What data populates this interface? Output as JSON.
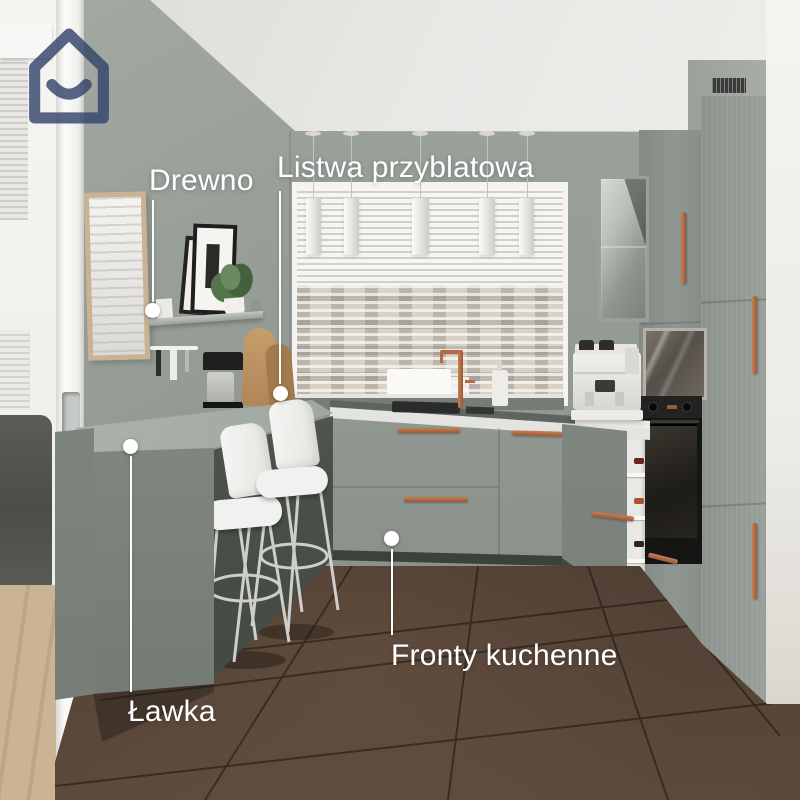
{
  "brand": {
    "logo_icon": "house-smile-logo",
    "logo_color": "#35456b"
  },
  "annotations": {
    "drewno": {
      "label": "Drewno"
    },
    "listwa_przyblatowa": {
      "label": "Listwa przyblatowa"
    },
    "lawka": {
      "label": "Ławka"
    },
    "fronty_kuchenne": {
      "label": "Fronty kuchenne"
    }
  },
  "colors": {
    "label_white": "#ffffff",
    "brand_navy": "#35456b",
    "accent_copper": "#b26b45",
    "wall_sage": "#929993",
    "cabinet_sage": "#8d948e",
    "floor_brown": "#3a2e25"
  }
}
